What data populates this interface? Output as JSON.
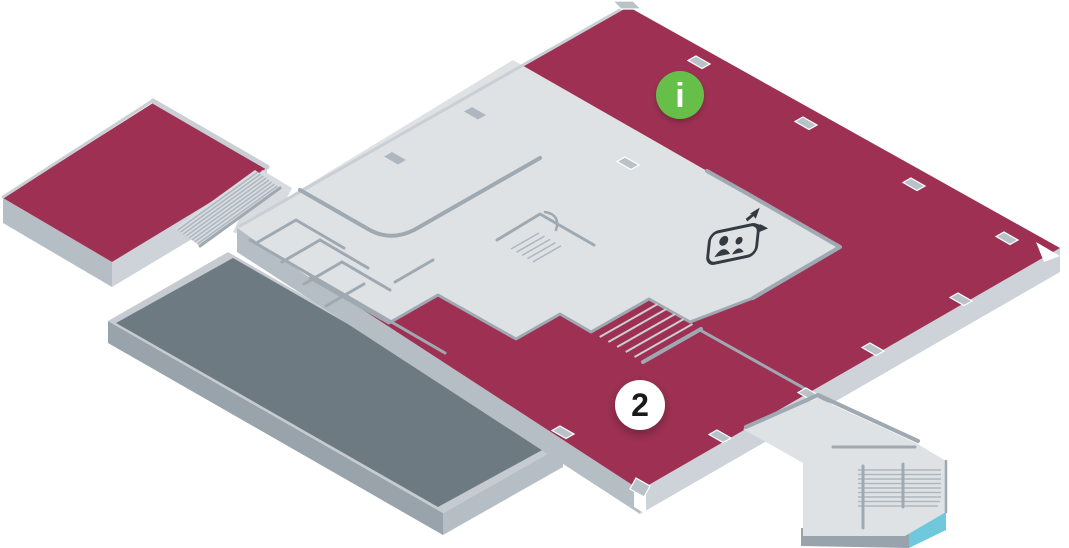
{
  "map": {
    "name": "isometric-floor-plan",
    "floor_number": "2",
    "markers": [
      {
        "id": "information-point",
        "label": "i",
        "shape": "circle",
        "fill": "#66BF4A",
        "text_color": "#FFFFFF"
      },
      {
        "id": "floor-level-badge",
        "label": "2",
        "shape": "circle",
        "fill": "#FFFFFF",
        "text_color": "#1B1B1B"
      }
    ],
    "icons": [
      {
        "name": "elevator-icon",
        "description": "two persons in cab with up and down arrows"
      },
      {
        "name": "stairs",
        "count": 4
      }
    ],
    "zones": [
      {
        "name": "highlighted-floor-area",
        "color": "#9E3153"
      },
      {
        "name": "corridor-area",
        "color": "#DFE2E5"
      },
      {
        "name": "lower-roof-terrace",
        "color": "#6E7A82"
      },
      {
        "name": "escalator-accent",
        "color": "#6FC8DB"
      }
    ]
  },
  "colors": {
    "bg": "#FFFFFF",
    "zone_primary": "#9E3153",
    "corridor": "#DFE2E5",
    "corridor_dim": "#D8DCE0",
    "wall": "#9FA9B2",
    "wall_soft": "#C9CFD5",
    "slab_light": "#CDD3D8",
    "slab_mid": "#B6BEC5",
    "slab_dark": "#99A3AB",
    "roof": "#6E7A82",
    "roof_border": "#C5CBD1",
    "step": "#C9CFD3",
    "mark": "#B9C2C9",
    "mark_dim": "#AEB7BF",
    "accent_cyan": "#6FC8DB",
    "info_green": "#66BF4A",
    "icon_dark": "#343A42",
    "white": "#FFFFFF",
    "text_dark": "#1B1B1B"
  }
}
